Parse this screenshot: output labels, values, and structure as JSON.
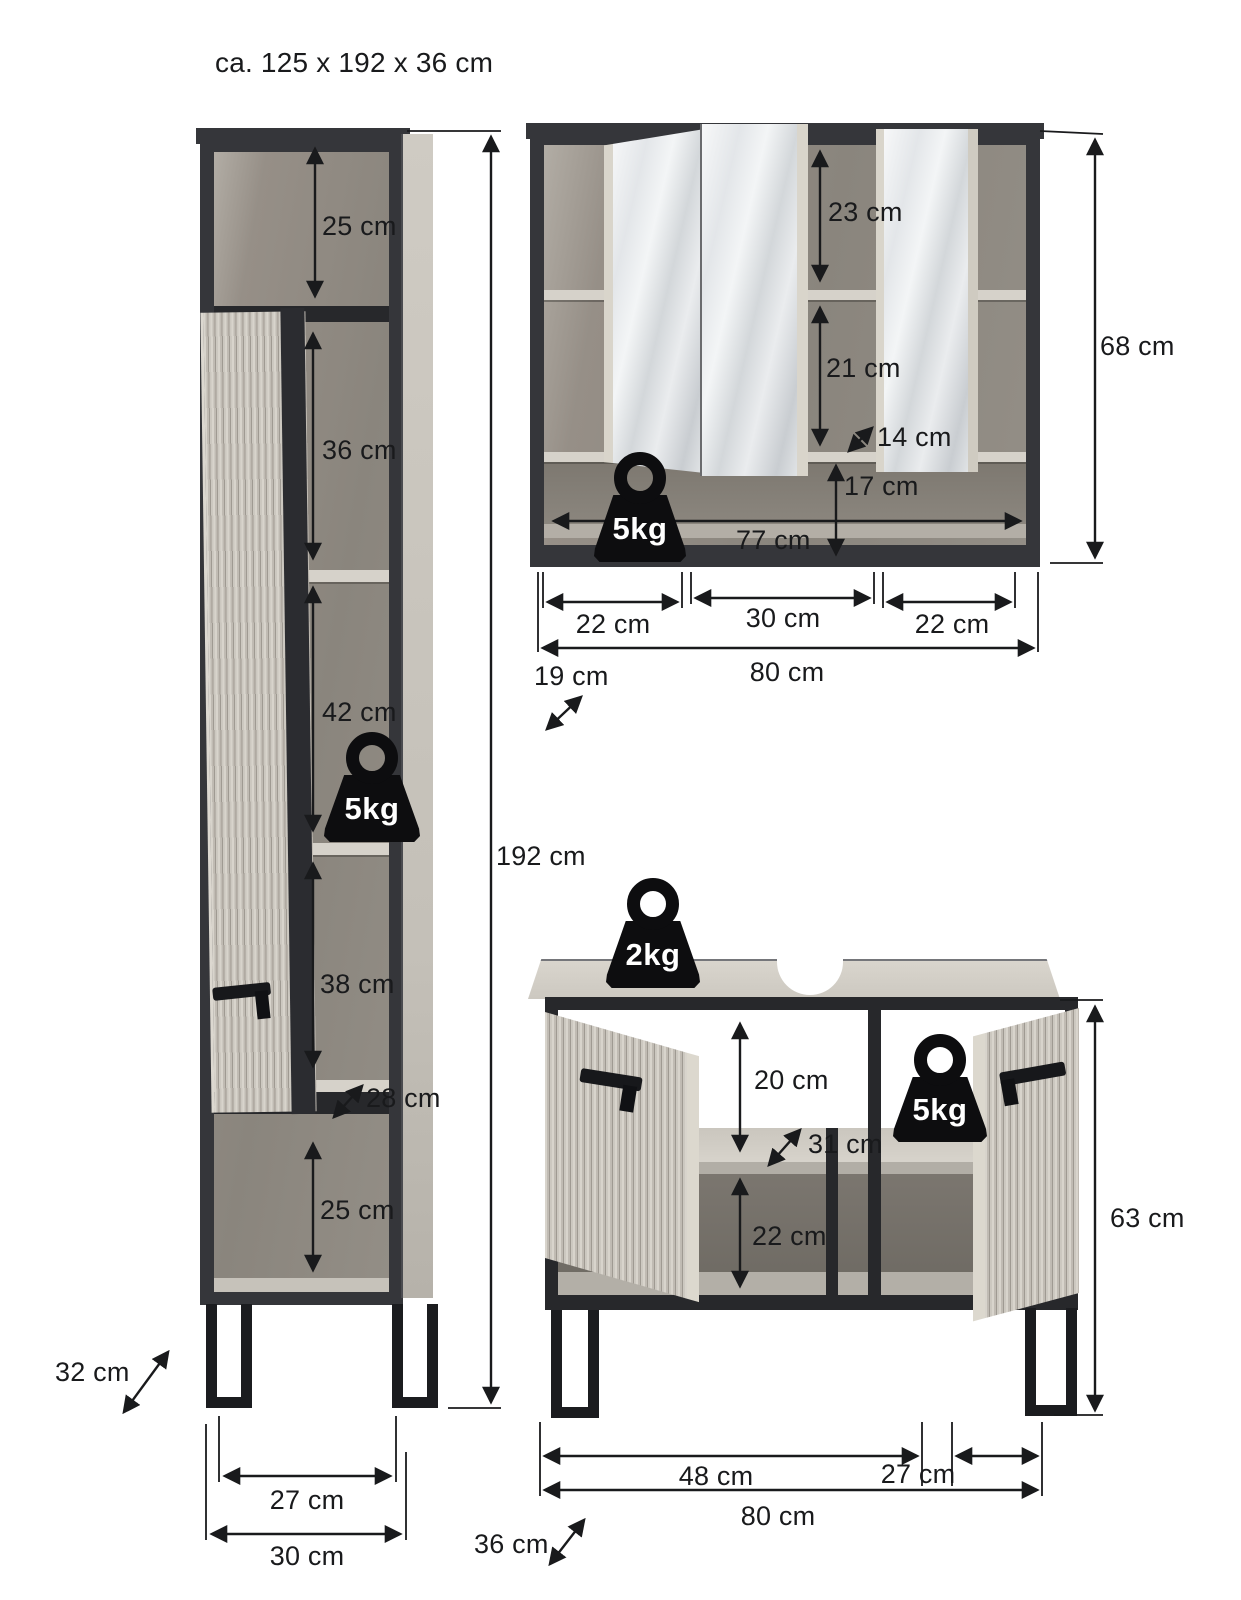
{
  "title": "ca. 125 x 192 x 36 cm",
  "tall": {
    "weight": "5kg",
    "d_top": "25 cm",
    "d_upper": "36 cm",
    "d_mid": "42 cm",
    "d_lower": "38 cm",
    "d_shelf_depth": "28 cm",
    "d_bottom": "25 cm",
    "d_height": "192 cm",
    "d_depth": "32 cm",
    "d_leg_span": "27 cm",
    "d_width": "30 cm"
  },
  "mirror": {
    "weight": "5kg",
    "d_top": "23 cm",
    "d_mid": "21 cm",
    "d_shelf_depth": "14 cm",
    "d_bottom": "17 cm",
    "d_inner_width": "77 cm",
    "d_height": "68 cm",
    "d_left": "22 cm",
    "d_center": "30 cm",
    "d_right": "22 cm",
    "d_width": "80 cm",
    "d_depth": "19 cm"
  },
  "sink": {
    "weight_top": "2kg",
    "weight_side": "5kg",
    "d_open": "20 cm",
    "d_shelf_depth": "31 cm",
    "d_bottom": "22 cm",
    "d_height": "63 cm",
    "d_left": "48 cm",
    "d_right": "27 cm",
    "d_width": "80 cm",
    "d_depth": "36 cm"
  }
}
